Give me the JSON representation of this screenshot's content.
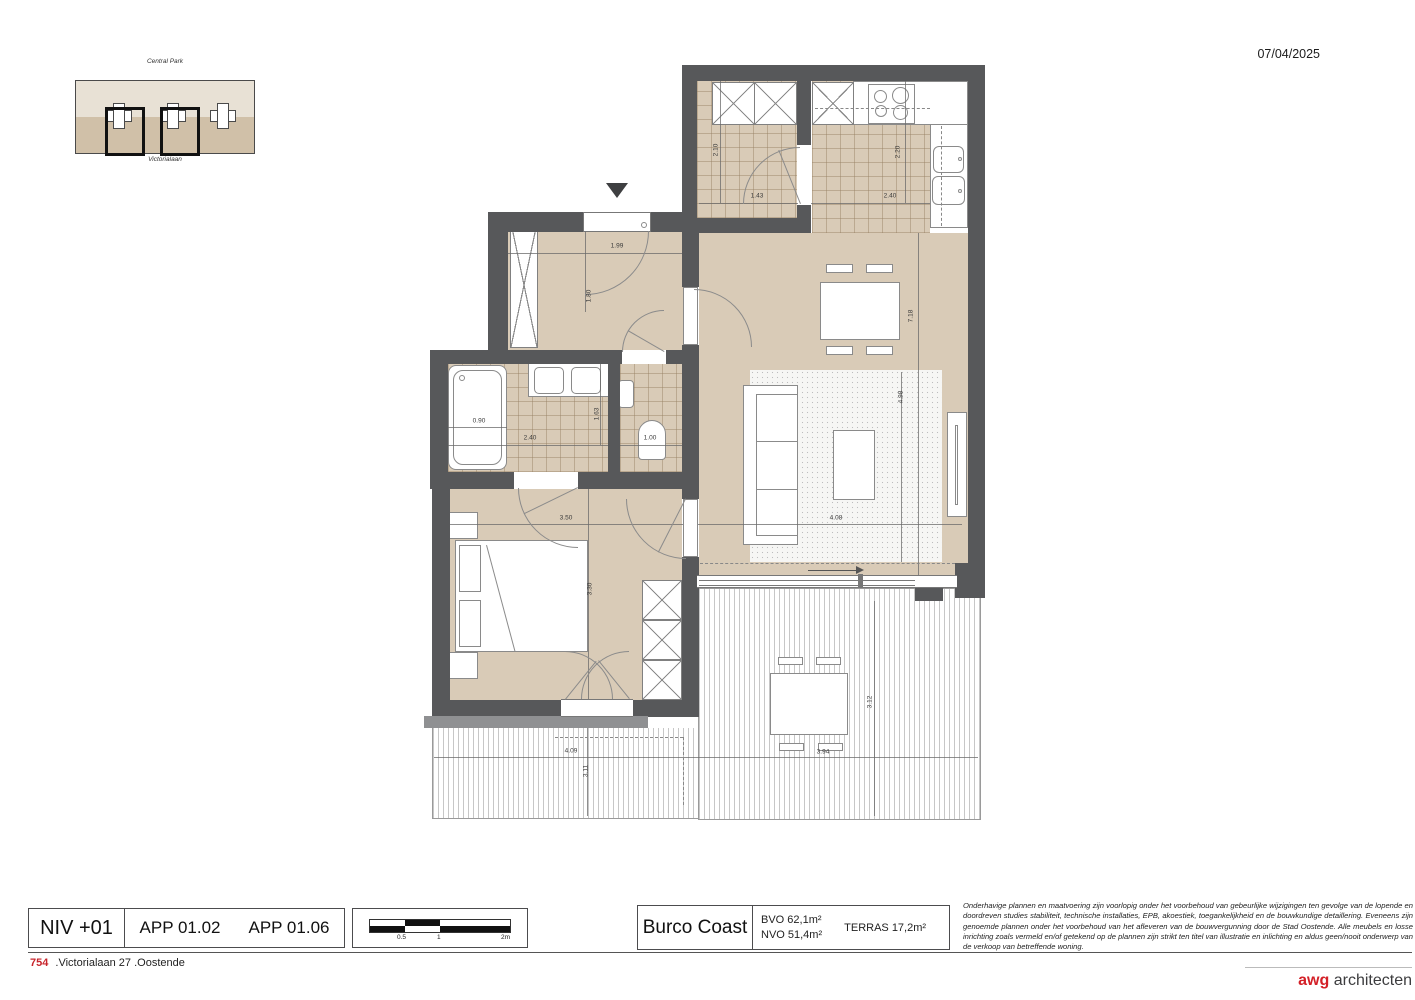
{
  "sheet": {
    "date": "07/04/2025"
  },
  "site_plan": {
    "area_label": "Central Park",
    "street_label": "Victorialaan"
  },
  "title_block": {
    "level": "NIV +01",
    "apartment_1": "APP 01.02",
    "apartment_2": "APP 01.06",
    "scale_labels": [
      "0.5",
      "1",
      "2m"
    ],
    "project": "Burco Coast",
    "area_bvo": "BVO 62,1m²",
    "area_nvo": "NVO 51,4m²",
    "area_terras": "TERRAS 17,2m²",
    "disclaimer": "Onderhavige plannen en maatvoering zijn voorlopig onder het voorbehoud van gebeurlijke wijzigingen ten gevolge van de lopende en doordreven studies stabiliteit, technische installaties, EPB, akoestiek, toegankelijkheid en de bouwkundige detaillering. Eveneens zijn genoemde plannen onder het voorbehoud van het afleveren van de bouwvergunning door de Stad Oostende. Alle meubels en losse inrichting zoals vermeld en/of getekend op de plannen zijn strikt ten titel van illustratie en inlichting en aldus geen/nooit onderwerp van de verkoop van betreffende woning.",
    "project_number": "754",
    "address": ".Victorialaan 27 .Oostende",
    "logo_primary": "awg",
    "logo_secondary": "architecten"
  },
  "plan": {
    "dims": [
      {
        "label": "2.10"
      },
      {
        "label": "1.43"
      },
      {
        "label": "2.20"
      },
      {
        "label": "2.40"
      },
      {
        "label": "1.99"
      },
      {
        "label": "1.80"
      },
      {
        "label": "0.90"
      },
      {
        "label": "2.40"
      },
      {
        "label": "1.63"
      },
      {
        "label": "1.00"
      },
      {
        "label": "3.50"
      },
      {
        "label": "3.30"
      },
      {
        "label": "7.18"
      },
      {
        "label": "4.98"
      },
      {
        "label": "4.08"
      },
      {
        "label": "4.09"
      },
      {
        "label": "3.11"
      },
      {
        "label": "3.94"
      },
      {
        "label": "3.12"
      }
    ]
  },
  "colors": {
    "wall": "#57585a",
    "floor": "#d9cbb7",
    "carpet": "#f6f6f4",
    "terrace_stripe": "#c7c7c7",
    "accent_red": "#c8252c",
    "highlight_black": "#111111"
  }
}
